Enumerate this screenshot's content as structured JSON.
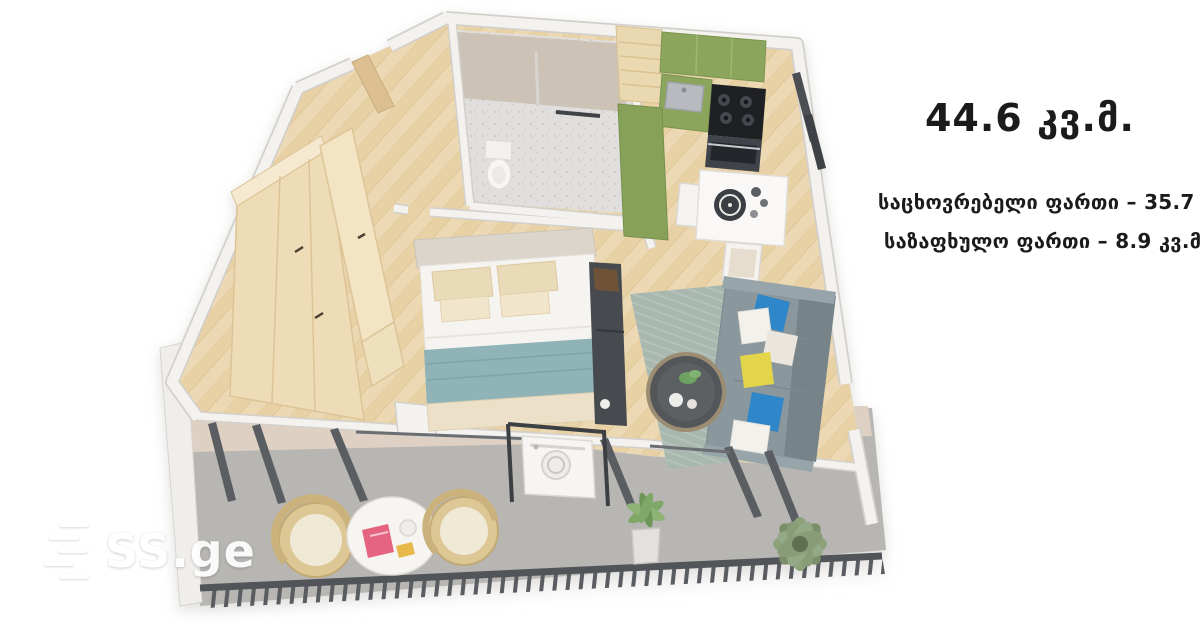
{
  "info_panel": {
    "total_area": "44.6 კვ.მ.",
    "living_area": "საცხოვრებელი ფართი – 35.7 კვ.მ.",
    "summer_area": "საზაფხულო ფართი – 8.9 კვ.მ."
  },
  "watermark": {
    "brand": "SS.ge"
  },
  "floorplan": {
    "type": "3d-isometric-apartment-floor-plan",
    "total_area_sqm": 44.6,
    "living_area_sqm": 35.7,
    "summer_area_sqm": 8.9,
    "rooms": [
      {
        "name": "entrance-hall",
        "furniture": [
          "wooden-entrance-door"
        ]
      },
      {
        "name": "bathroom",
        "furniture": [
          "toilet",
          "towel-rail",
          "terrazzo-floor"
        ]
      },
      {
        "name": "kitchen",
        "furniture": [
          "green-upper-cabinets",
          "green-base-cabinet",
          "steel-sink",
          "black-cooktop-with-oven",
          "tall-green-cabinet",
          "wood-tall-cabinet",
          "wall-radiator"
        ]
      },
      {
        "name": "dining-corner",
        "furniture": [
          "white-square-table",
          "dark-tray",
          "two-white-chairs"
        ]
      },
      {
        "name": "wardrobe-corner",
        "furniture": [
          "light-wood-wardrobe-with-open-doors"
        ]
      },
      {
        "name": "bedroom",
        "furniture": [
          "double-bed",
          "beige-pillows",
          "teal-blanket",
          "dark-tv-console"
        ]
      },
      {
        "name": "living-room",
        "furniture": [
          "gray-sofa",
          "blue-white-yellow-pillows",
          "round-dark-coffee-table",
          "sage-rug"
        ]
      },
      {
        "name": "balcony",
        "furniture": [
          "washing-machine-in-glass-niche",
          "two-rattan-chairs",
          "round-white-table",
          "potted-fern",
          "large-leafy-plant",
          "dark-metal-railing"
        ]
      }
    ]
  },
  "colors": {
    "background": "#ffffff",
    "text": "#1b1b1b",
    "watermark": "#ffffff",
    "wall": "#f4f2ef",
    "wall_shadow": "#d3d0cb",
    "wood_floor": "#ecd9b3",
    "furniture_wood": "#eedcb6",
    "kitchen_green": "#8ba65c",
    "tile_gray": "#e0dfdd",
    "rug_sage": "#a9b8af",
    "sofa_gray": "#8a979d",
    "blanket_teal": "#8fb3b6",
    "pillow_blue": "#2f86c8",
    "pillow_yellow": "#e3d54a",
    "balcony_floor": "#b8b6b3",
    "balcony_wall_beige": "#ded1c3",
    "railing_dark": "#55585c",
    "plant_green": "#8fa07e",
    "appliance_black": "#1e2023"
  }
}
